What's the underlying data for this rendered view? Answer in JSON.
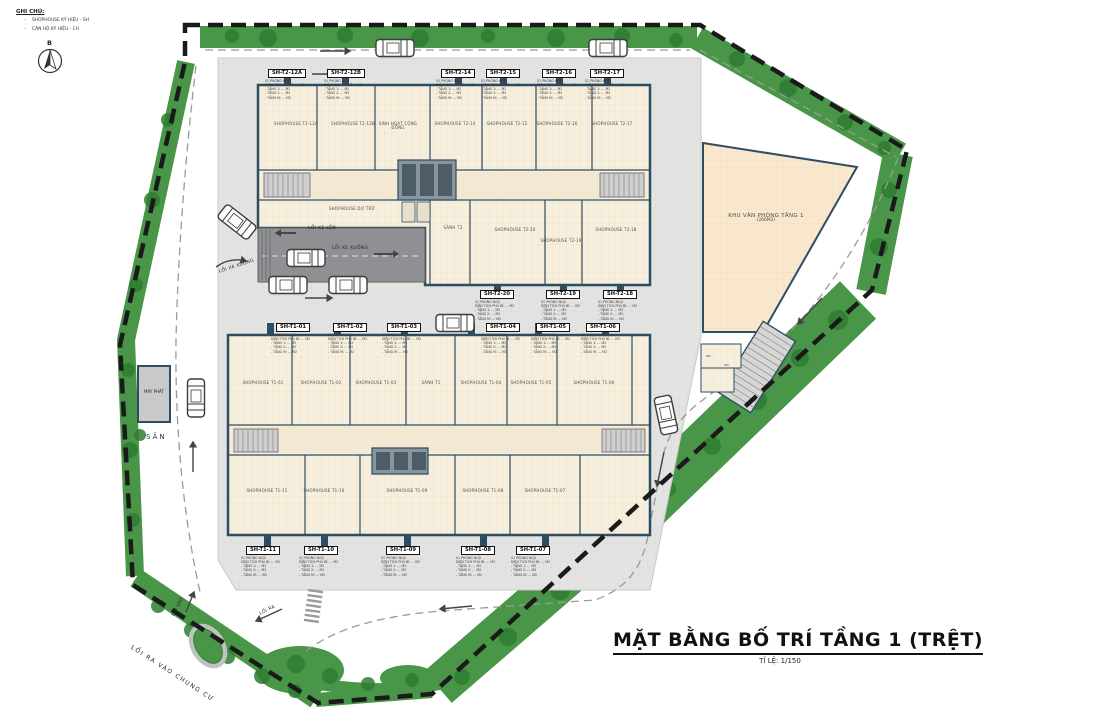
{
  "legend": {
    "title": "GHI CHÚ:",
    "bullet": "-",
    "items": [
      "SHOPHOUSE KÝ HIỆU - SH",
      "CĂN HỘ KÝ HIỆU - CH"
    ]
  },
  "compass": {
    "north": "B"
  },
  "callout_details": "01 PHÒNG NGỦ\nDIỆN TÍCH PHỦ BÌ: … M2\n- TẦNG 1: … M2\n- TẦNG 2: … M2\n- TẦNG M: … M2",
  "callouts": {
    "t2_top": [
      "SH-T2-12A",
      "SH-T2-12B",
      "SH-T2-14",
      "SH-T2-15",
      "SH-T2-16",
      "SH-T2-17"
    ],
    "t2_bottom": [
      "SH-T2-20",
      "SH-T2-19",
      "SH-T2-18"
    ],
    "t1_top": [
      "SH-T1-01",
      "SH-T1-02",
      "SH-T1-03",
      "SH-T1-04",
      "SH-T1-05",
      "SH-T1-06"
    ],
    "t1_bottom": [
      "SH-T1-11",
      "SH-T1-10",
      "SH-T1-09",
      "SH-T1-08",
      "SH-T1-07"
    ]
  },
  "units": {
    "t2_row_top": [
      "SHOPHOUSE T2-12A",
      "SHOPHOUSE T2-12B",
      "SINH HOẠT CỘNG ĐỒNG",
      "SHOPHOUSE T2-14",
      "SHOPHOUSE T2-15",
      "SHOPHOUSE T2-16",
      "SHOPHOUSE T2-17"
    ],
    "t2_row_bottom": [
      "SHOPHOUSE DỰ TRỮ",
      "SẢNH T2",
      "SHOPHOUSE T2-20",
      "SHOPHOUSE T2-19",
      "SHOPHOUSE T2-18"
    ],
    "t1_row_top": [
      "SHOPHOUSE T1-01",
      "SHOPHOUSE T1-02",
      "SHOPHOUSE T1-03",
      "SẢNH T1",
      "SHOPHOUSE T1-04",
      "SHOPHOUSE T1-05",
      "SHOPHOUSE T1-06"
    ],
    "t1_row_bottom": [
      "SHOPHOUSE T1-11",
      "SHOPHOUSE T1-10",
      "SHOPHOUSE T1-09",
      "SHOPHOUSE T1-08",
      "SHOPHOUSE T1-07"
    ],
    "wc": "WC"
  },
  "office": {
    "line1": "KHU VĂN PHÒNG TẦNG 1",
    "line2": "(266M2)"
  },
  "roads": {
    "loi_xe_len": "LỐI XE LÊN",
    "loi_xe_xuong": "LỐI XE XUỐNG",
    "loi_xe_xuong_outer": "LỐI XE XUỐNG",
    "loi_vao": "LỐI VÀO",
    "loi_ra": "LỐI RA",
    "loi_ra_vao_chung_cu": "LỐI RA VÀO CHUNG CƯ",
    "san": "SÂN",
    "may_phat": "MÁY PHÁT"
  },
  "title_block": {
    "title": "MẶT BẰNG BỐ TRÍ TẦNG 1 (TRỆT)",
    "scale": "TỈ LỆ: 1/150"
  },
  "colors": {
    "green": "#4a9648",
    "tree": "#2e7d32",
    "boundary": "#1a1a1a",
    "building_fill": "#f7efdd",
    "wall": "#2d4d62",
    "plaza": "#e3e3e1",
    "ramp": "#8e9093",
    "office_fill": "#f9e8cd",
    "road_line": "#9a9a9a"
  }
}
